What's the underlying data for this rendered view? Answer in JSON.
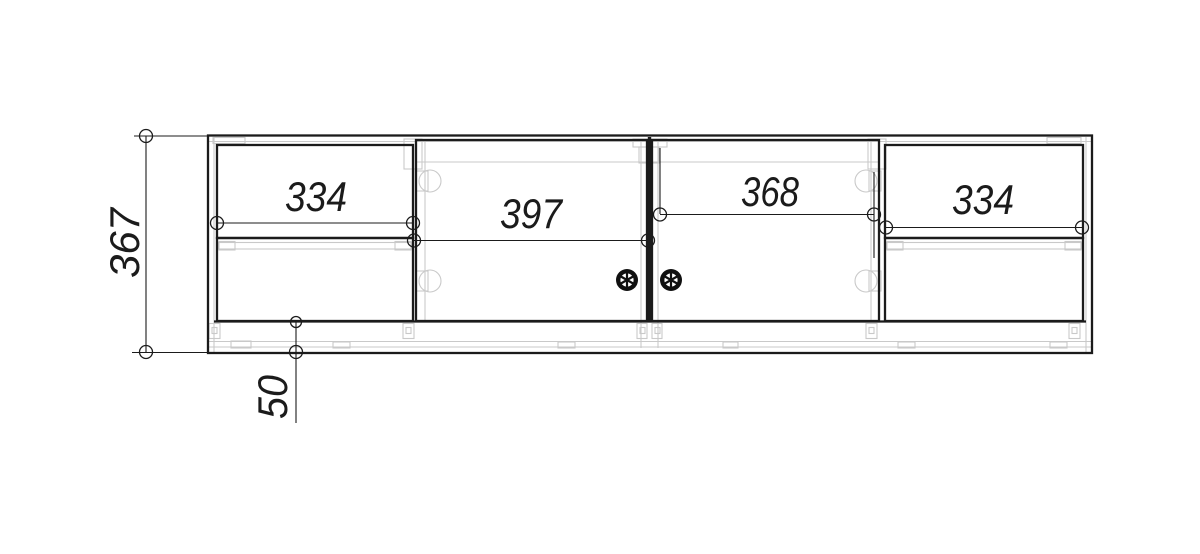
{
  "drawing": {
    "background_color": "#ffffff",
    "line_color": "#1b1b1b",
    "hardware_color": "#c9c9c9",
    "dimensions": {
      "overall_height": "367",
      "left_drawers_width": "334",
      "left_door_width": "397",
      "right_door_width": "368",
      "right_drawers_width": "334",
      "plinth_height": "50"
    }
  }
}
